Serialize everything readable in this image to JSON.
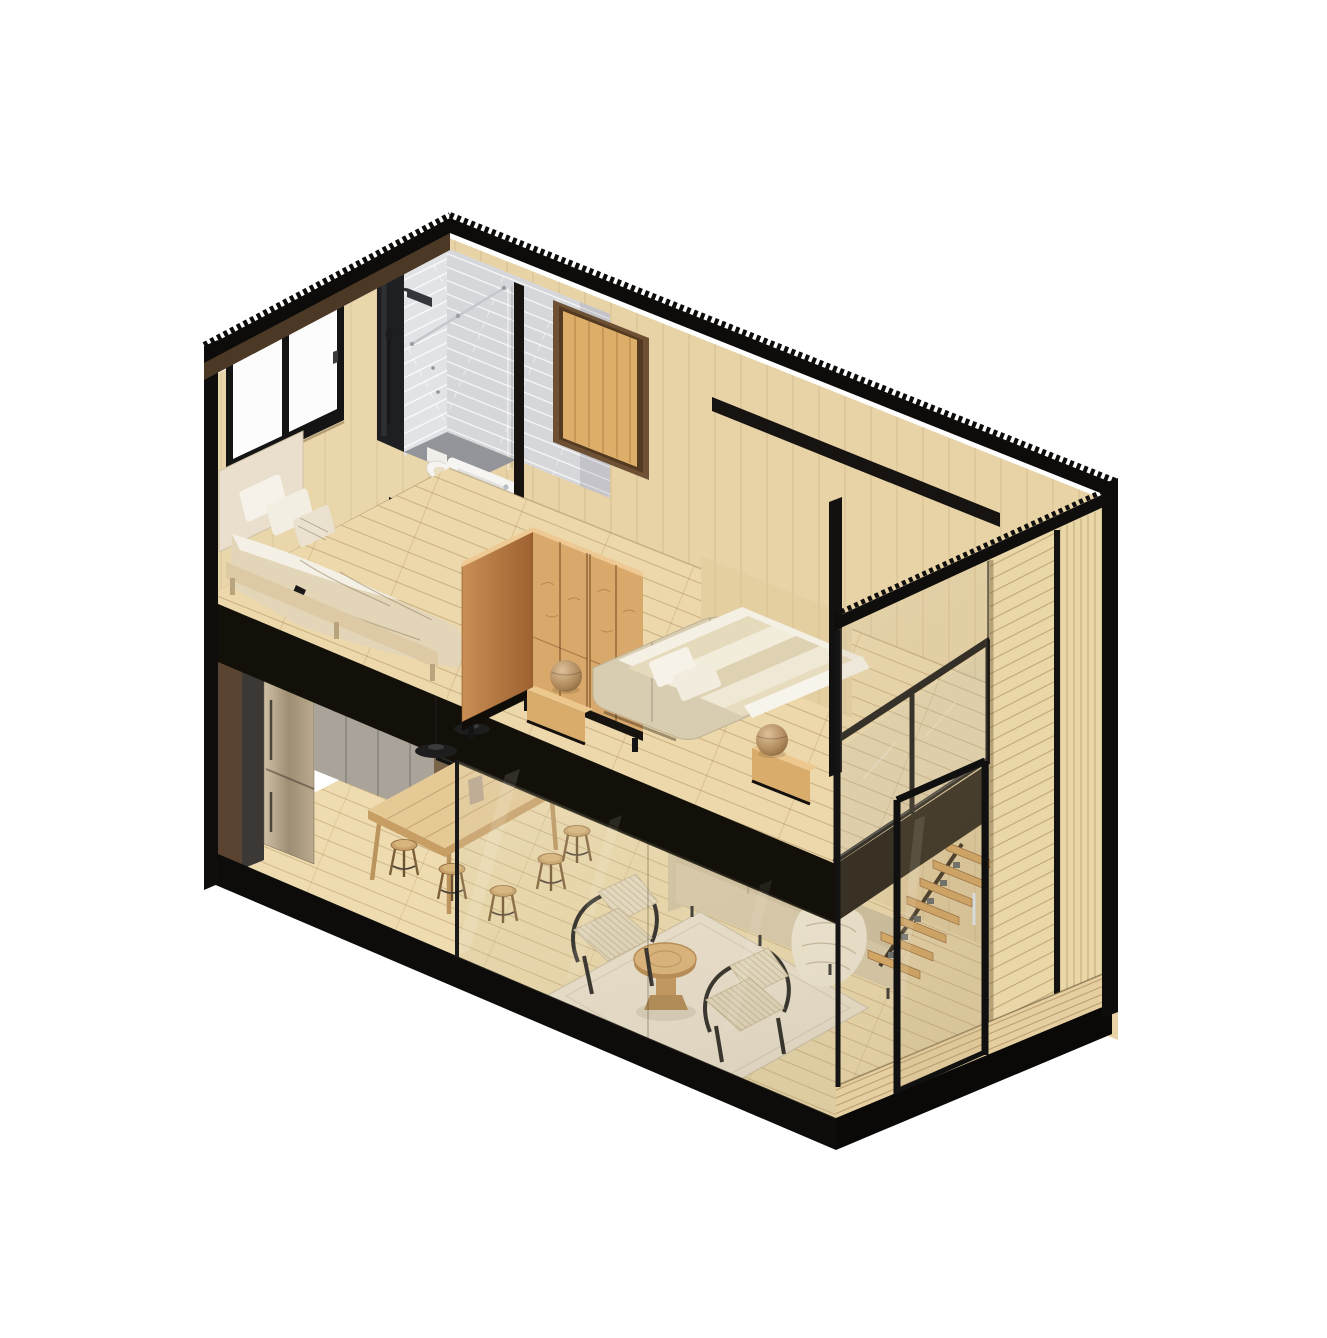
{
  "meta": {
    "kind": "isometric-cutaway-rendering",
    "subject": "two-storey prefab cabin module, dollhouse section view",
    "background": "#ffffff"
  },
  "colors": {
    "background": "#ffffff",
    "frame_black": "#0f0e0c",
    "slab_black": "#121008",
    "roof_underside_brown": "#4b3926",
    "wall_wood": "#e7d3a6",
    "end_wall_wood": "#e9d6ab",
    "headboard_wall": "#e4cfa1",
    "floor_upper": "#ecd8ab",
    "floor_lower": "#eedcb0",
    "tile_light": "#e2e3e6",
    "tile_shaded": "#d6d7db",
    "shower_panel": "#1e1f22",
    "chrome": "#c3c8cd",
    "door_wood": "#dcae69",
    "wardrobe_front": "#d9a96b",
    "wardrobe_side_dark": "#b07840",
    "nightstand_wood": "#d9ac6c",
    "bed_linen": "#f4f0e4",
    "duvet_beige": "#e2d5b8",
    "boucle_upholstery": "#d9cdb1",
    "sofa_body": "#d9cbad",
    "throw_blanket": "#f1ead8",
    "rug": "#ece4d3",
    "rattan_weave": "#e9dfc6",
    "table_wood": "#e5ca96",
    "stool_wood": "#c9a26b",
    "counter_gray": "#a9a39a",
    "counter_top": "#cfcbc3",
    "fridge_brass": "#b3a386",
    "oven_black": "#121212",
    "pendant_black": "#1d1d1d",
    "stair_wood": "#d8a65f",
    "slat_wall": "#ead7a8",
    "deck_wood": "#e5cfa0",
    "plinth_black": "#0d0c0a",
    "glass_tint": "rgba(200,178,135,0.16)",
    "pouf_tan": "#c8a16e"
  },
  "scene": {
    "upper_floor": [
      {
        "room": "bathroom",
        "items": [
          "walk-in-shower",
          "rain-shower-head",
          "hand-shower",
          "glass-screen",
          "stabilizer-bar",
          "bathtub",
          "toilet",
          "subway-tiles"
        ]
      },
      {
        "room": "bedroom-single",
        "items": [
          "single-bed",
          "pillows",
          "duvet",
          "window"
        ]
      },
      {
        "room": "bedroom-double",
        "items": [
          "double-bed",
          "boucle-surround",
          "wardrobe",
          "nightstands",
          "ball-poufs",
          "glass-balustrade"
        ]
      }
    ],
    "lower_floor": [
      {
        "room": "kitchen",
        "items": [
          "fridge",
          "sink",
          "black-faucet",
          "oven",
          "counter-cabinets",
          "backsplash"
        ]
      },
      {
        "room": "dining",
        "items": [
          "wood-table",
          "bar-stools",
          "pendant-lamps",
          "bread-board",
          "jug",
          "cup"
        ]
      },
      {
        "room": "living",
        "items": [
          "sofa",
          "throw-blanket",
          "pillows",
          "rug",
          "lounge-chairs",
          "round-coffee-table",
          "floating-stairs"
        ]
      }
    ],
    "exterior": [
      "serrated-section-roofline",
      "black-steel-frame",
      "timber-slat-cladding",
      "glass-sliding-door",
      "timber-deck",
      "black-plinth"
    ]
  }
}
